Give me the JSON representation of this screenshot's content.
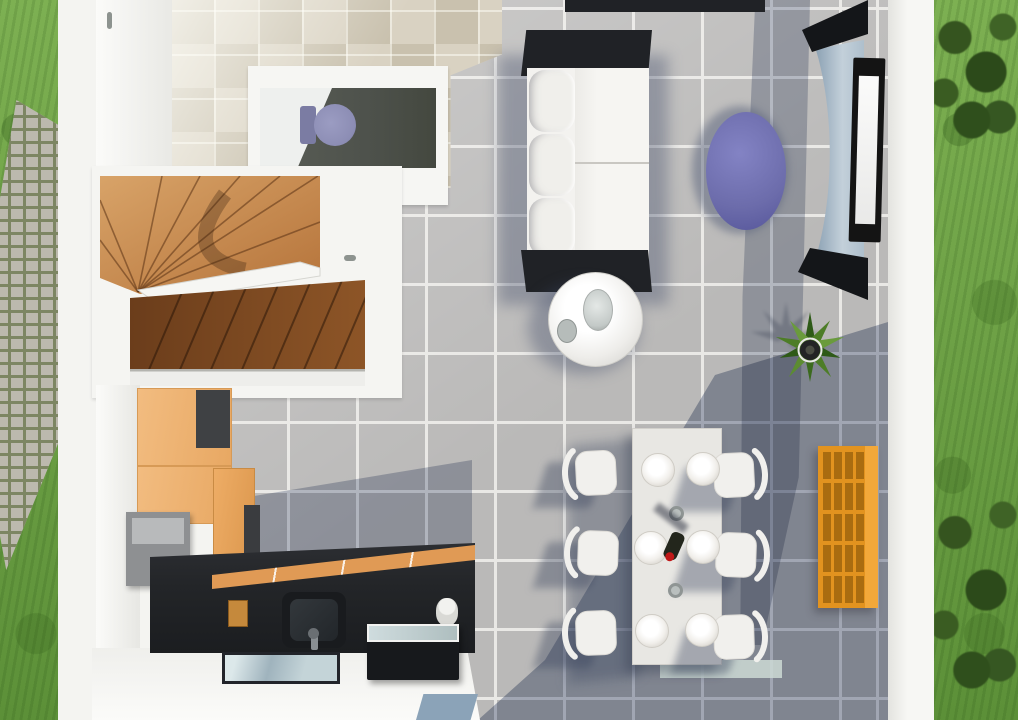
{
  "meta": {
    "description": "Top-down 3D architectural render of a house ground floor, flanked by garden lawn strips and a paver path",
    "view": "top-down dollhouse render",
    "visible_text": []
  },
  "palette": {
    "grass_light": "#7db052",
    "grass_dark": "#5c9038",
    "bush_dark": "#35541f",
    "paver_stone": "#bcb9ae",
    "paver_gap": "#7d8663",
    "wall_white": "#f4f4f1",
    "tile_gray": "#bab9b8",
    "grout": "#e9e8e5",
    "tile_beige_a": "#d9d2c2",
    "tile_beige_b": "#c9c1ae",
    "wc_floor": "#4e524c",
    "toilet": "#8c8db4",
    "toilet_dark": "#7b7ca3",
    "wood_light": "#cf9a5f",
    "wood_mid": "#b5733a",
    "wood_dark": "#6b3d1b",
    "cabinet_orange": "#f2bc80",
    "counter_black": "#232528",
    "counter_wood": "#e09a55",
    "shelf_orange": "#e2931f",
    "shelf_cell": "#a96c10",
    "table_purple": "#6c6cab",
    "sofa_frame": "#202226",
    "cushion": "#f3f2ef",
    "console_gray": "#b5c3cf",
    "console_cap": "#141619",
    "tv_frame": "#141414",
    "plant_green": "#4a7a28",
    "plant_dark": "#2e5a17",
    "pot": "#232425",
    "glass": "#9fb3bd",
    "glass_light": "#ccd9d5",
    "dining_table": "#e8e7e3",
    "plate_rim": "#dcd9d3",
    "bottle": "#23261c",
    "bottle_cap": "#c01818",
    "shadow_blue": "#5a678a"
  },
  "scene": {
    "outdoor": {
      "left": [
        "lawn",
        "paver-path"
      ],
      "right": [
        "lawn",
        "shrubs-top",
        "shrubs-bottom"
      ]
    },
    "rooms": {
      "entry_hall": {
        "floor": "beige-tiles",
        "objects": [
          "door-handle"
        ]
      },
      "wc": {
        "floor": "dark-gray",
        "objects": [
          "toilet",
          "door-handle"
        ]
      },
      "staircase": {
        "type": "u-shaped winder",
        "material": "wood",
        "objects": [
          "white-railing"
        ]
      },
      "kitchen": {
        "objects": [
          "tall-orange-cabinets",
          "gray-appliance",
          "black-countertop",
          "sink",
          "faucet",
          "utensil-box",
          "glass-top-oven-unit",
          "window"
        ]
      },
      "living_room": {
        "floor": "gray-tiles",
        "objects": [
          "white-sofa",
          "round-coffee-table",
          "purple-side-table",
          "tv",
          "curved-tv-console",
          "potted-plant",
          "orange-cube-shelf",
          "top-edge-cabinet",
          "patio-glass-door"
        ]
      },
      "dining_area": {
        "chairs": 6,
        "plates": 6,
        "glasses": 2,
        "bottles": 1,
        "objects": [
          "white-dining-table"
        ]
      }
    }
  }
}
